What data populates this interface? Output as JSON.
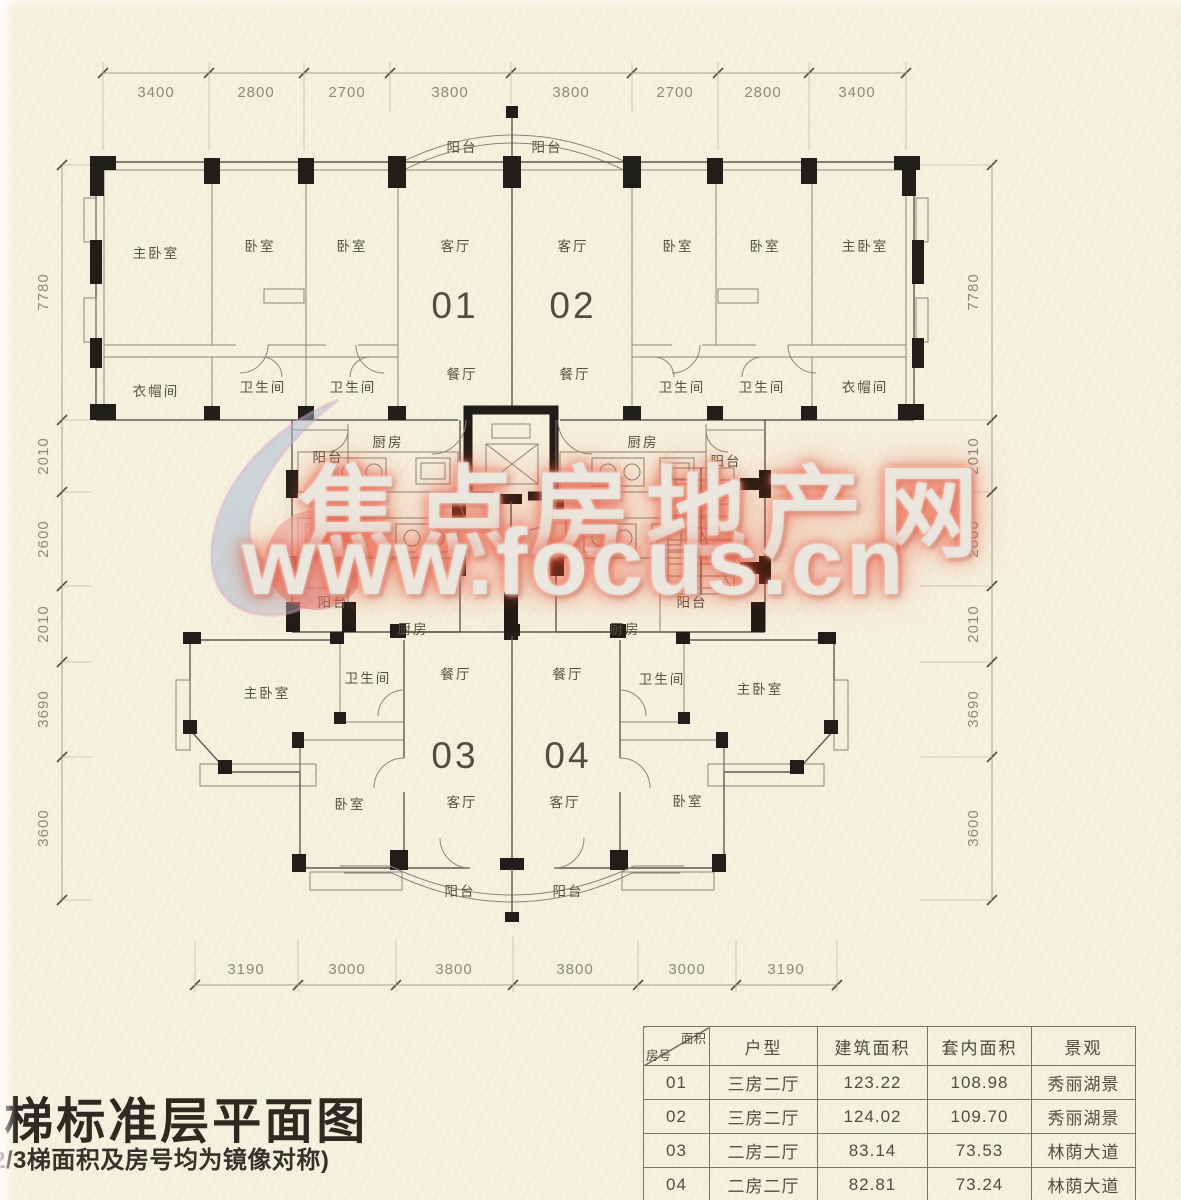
{
  "title": {
    "main": "3梯标准层平面图",
    "note": "2/3梯面积及房号均为镜像对称)"
  },
  "watermark": {
    "line1": "焦点房地产网",
    "line2": "www.focus.cn",
    "glow_color": "#e9482e"
  },
  "colors": {
    "paper": "#f4efdc",
    "ink": "#4f4c43",
    "column_black": "#201e18",
    "dim_text": "#8e8a77"
  },
  "units": {
    "u01": "01",
    "u02": "02",
    "u03": "03",
    "u04": "04"
  },
  "rooms": {
    "master_bedroom": "主卧室",
    "bedroom": "卧室",
    "living_room": "客厅",
    "dining_room": "餐厅",
    "bathroom": "卫生间",
    "cloakroom": "衣帽间",
    "kitchen": "厨房",
    "balcony": "阳台"
  },
  "dimensions": {
    "top": [
      "3400",
      "2800",
      "2700",
      "3800",
      "3800",
      "2700",
      "2800",
      "3400"
    ],
    "bottom": [
      "3190",
      "3000",
      "3800",
      "3800",
      "3000",
      "3190"
    ],
    "left": [
      "7780",
      "2010",
      "2600",
      "2010",
      "3690",
      "3600"
    ],
    "right": [
      "7780",
      "2010",
      "2600",
      "2010",
      "3690",
      "3600"
    ]
  },
  "table": {
    "corner": {
      "top_right": "面积",
      "bottom_left": "房号"
    },
    "headers": [
      "户型",
      "建筑面积",
      "套内面积",
      "景观"
    ],
    "rows": [
      {
        "no": "01",
        "type": "三房二厅",
        "built_area": "123.22",
        "inner_area": "108.98",
        "view": "秀丽湖景"
      },
      {
        "no": "02",
        "type": "三房二厅",
        "built_area": "124.02",
        "inner_area": "109.70",
        "view": "秀丽湖景"
      },
      {
        "no": "03",
        "type": "二房二厅",
        "built_area": "83.14",
        "inner_area": "73.53",
        "view": "林荫大道"
      },
      {
        "no": "04",
        "type": "二房二厅",
        "built_area": "82.81",
        "inner_area": "73.24",
        "view": "林荫大道"
      }
    ]
  }
}
